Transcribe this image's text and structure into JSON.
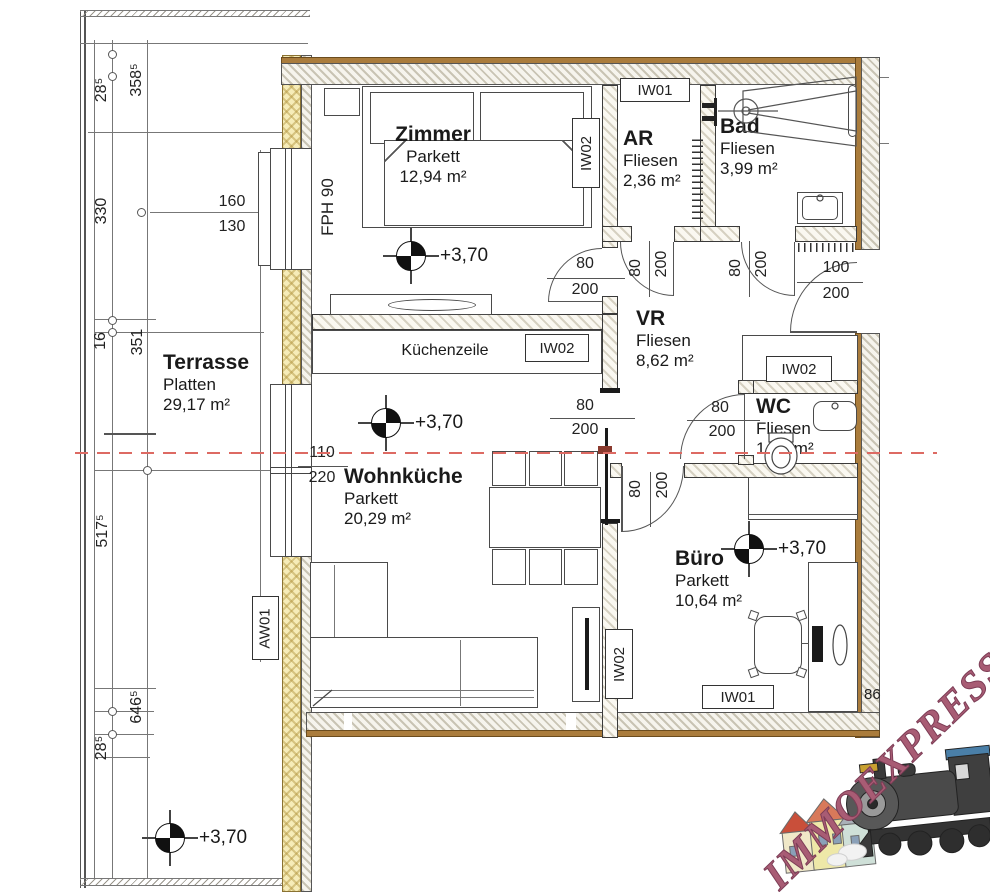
{
  "plan": {
    "level": "+3,70",
    "partial_dim": "86",
    "kitchen_label": "Küchenzeile",
    "labels": {
      "fph": "FPH 90",
      "aw01": "AW01",
      "iw01": "IW01",
      "iw02": "IW02"
    },
    "rooms": [
      {
        "name": "Zimmer",
        "floor": "Parkett",
        "area": "12,94 m²"
      },
      {
        "name": "AR",
        "floor": "Fliesen",
        "area": "2,36 m²"
      },
      {
        "name": "Bad",
        "floor": "Fliesen",
        "area": "3,99 m²"
      },
      {
        "name": "VR",
        "floor": "Fliesen",
        "area": "8,62 m²"
      },
      {
        "name": "WC",
        "floor": "Fliesen",
        "area": "1,40 m²"
      },
      {
        "name": "Büro",
        "floor": "Parkett",
        "area": "10,64 m²"
      },
      {
        "name": "Wohnküche",
        "floor": "Parkett",
        "area": "20,29 m²"
      },
      {
        "name": "Terrasse",
        "floor": "Platten",
        "area": "29,17 m²"
      }
    ],
    "door_dims": {
      "w80": "80",
      "h200": "200",
      "w100": "100"
    },
    "window_dims": {
      "w160": "160",
      "w130": "130",
      "w110": "110",
      "w220": "220"
    },
    "site_dims": {
      "a": "28⁵",
      "b": "358⁵",
      "c": "330",
      "d": "16",
      "e": "351",
      "f": "517⁵",
      "g": "646⁵",
      "h": "28⁵"
    },
    "colors": {
      "wall_brown": "#aa7c3c",
      "insulation": "#f6ecb8",
      "section_red": "#dd6a63",
      "logo": "#a85c74"
    },
    "logo": {
      "text": "IMMOEXPRESS"
    }
  }
}
